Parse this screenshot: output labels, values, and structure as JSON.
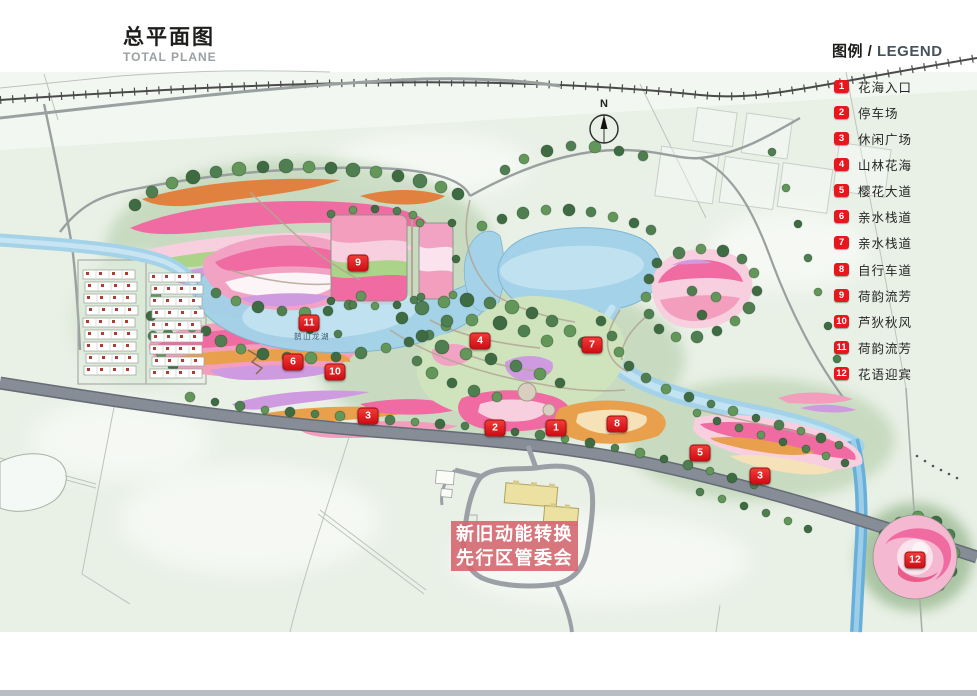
{
  "title": {
    "cn": "总平面图",
    "en": "TOTAL PLANE"
  },
  "legend": {
    "header_cn": "图例 /",
    "header_en": "LEGEND",
    "items": [
      {
        "num": "1",
        "label": "花海入口"
      },
      {
        "num": "2",
        "label": "停车场"
      },
      {
        "num": "3",
        "label": "休闲广场"
      },
      {
        "num": "4",
        "label": "山林花海"
      },
      {
        "num": "5",
        "label": "樱花大道"
      },
      {
        "num": "6",
        "label": "亲水栈道"
      },
      {
        "num": "7",
        "label": "亲水栈道"
      },
      {
        "num": "8",
        "label": "自行车道"
      },
      {
        "num": "9",
        "label": "荷韵流芳"
      },
      {
        "num": "10",
        "label": "芦狄秋风"
      },
      {
        "num": "11",
        "label": "荷韵流芳"
      },
      {
        "num": "12",
        "label": "花语迎宾"
      }
    ]
  },
  "map": {
    "north_label": "N",
    "lake_label": "鹊山龙湖",
    "building_label": {
      "line1": "新旧动能转换",
      "line2": "先行区管委会"
    },
    "markers": [
      {
        "num": "1"
      },
      {
        "num": "2"
      },
      {
        "num": "3"
      },
      {
        "num": "3"
      },
      {
        "num": "4"
      },
      {
        "num": "5"
      },
      {
        "num": "6"
      },
      {
        "num": "7"
      },
      {
        "num": "8"
      },
      {
        "num": "9"
      },
      {
        "num": "10"
      },
      {
        "num": "11"
      },
      {
        "num": "12"
      }
    ]
  },
  "colors": {
    "marker_red": "#e8161d",
    "water_blue": "#a4d2e8",
    "flower_pink": "#ef6ba2",
    "tree_green": "#4d7d50",
    "highway_gray": "#848a94"
  }
}
